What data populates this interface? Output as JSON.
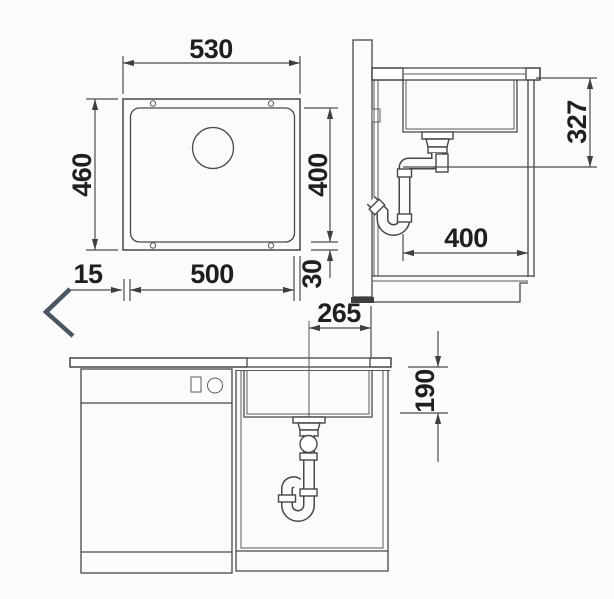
{
  "views": {
    "plan": {
      "dimensions": {
        "top_width": "530",
        "left_depth": "460",
        "bottom_width": "500",
        "bottom_left_offset": "15",
        "right_length": "400",
        "right_offset": "30"
      }
    },
    "side": {
      "dimensions": {
        "drain_height": "327",
        "clearance_width": "400"
      }
    },
    "front": {
      "dimensions": {
        "wall_to_drain": "265",
        "bowl_depth": "190"
      }
    }
  },
  "icons": {
    "navigation": "chevron-left-icon"
  },
  "colors": {
    "line": "#474747",
    "text": "#1f1f1f",
    "chevron": "#4a5664",
    "background": "#fbfbfb",
    "hatch": "#5c5c5c"
  }
}
